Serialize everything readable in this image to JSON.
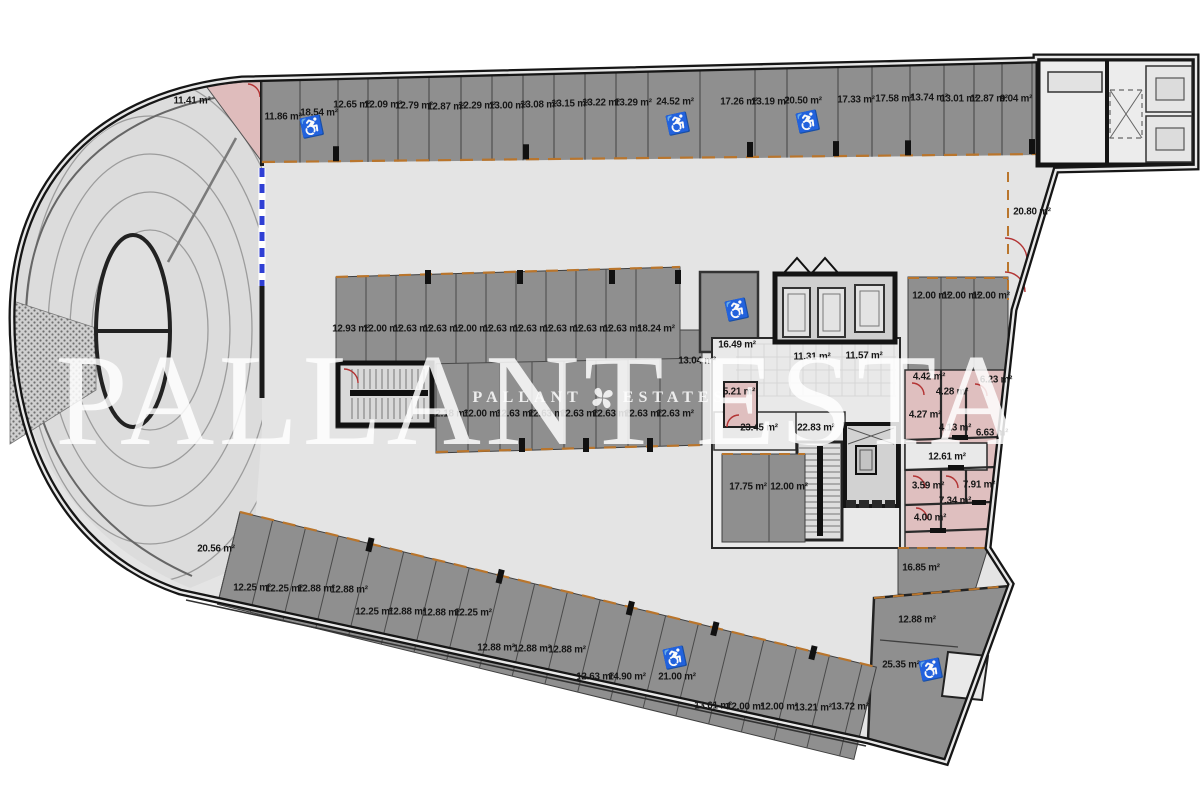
{
  "watermark": {
    "brand_left": "PALLANT",
    "brand_right": "ESTATES",
    "logo": "four-petal-flower"
  },
  "palette": {
    "stall_gray": "#8f8f8f",
    "aisle_gray": "#e4e4e4",
    "ramp_gray": "#dcdcdc",
    "room_pink": "#dfbfbf",
    "marking_orange": "#b9752c",
    "gate_blue": "#2f3fd4",
    "door_red": "#b33434",
    "wall_dark": "#1a1a1a",
    "watermark_white": "rgba(255,255,255,0.84)"
  },
  "plan": {
    "area_labels": [
      [
        "11.41 m²",
        192,
        101
      ],
      [
        "11.86 m²",
        283,
        117
      ],
      [
        "18.54 m²",
        319,
        113
      ],
      [
        "12.65 m²",
        352,
        105
      ],
      [
        "12.09 m²",
        383,
        105
      ],
      [
        "12.79 m²",
        414,
        106
      ],
      [
        "12.87 m²",
        446,
        107
      ],
      [
        "12.29 m²",
        477,
        106
      ],
      [
        "13.00 m²",
        508,
        106
      ],
      [
        "13.08 m²",
        539,
        105
      ],
      [
        "13.15 m²",
        570,
        104
      ],
      [
        "13.22 m²",
        601,
        103
      ],
      [
        "13.29 m²",
        633,
        103
      ],
      [
        "24.52 m²",
        675,
        102
      ],
      [
        "17.26 m²",
        739,
        102
      ],
      [
        "13.19 m²",
        770,
        102
      ],
      [
        "20.50 m²",
        803,
        101
      ],
      [
        "17.33 m²",
        856,
        100
      ],
      [
        "17.58 m²",
        894,
        99
      ],
      [
        "13.74 m²",
        929,
        98
      ],
      [
        "13.01 m²",
        959,
        99
      ],
      [
        "12.87 m²",
        989,
        99
      ],
      [
        "9.04 m²",
        1016,
        99
      ],
      [
        "12.93 m²",
        351,
        329
      ],
      [
        "12.00 m²",
        382,
        329
      ],
      [
        "12.63 m²",
        412,
        329
      ],
      [
        "12.63 m²",
        442,
        329
      ],
      [
        "12.00 m²",
        472,
        329
      ],
      [
        "12.63 m²",
        502,
        329
      ],
      [
        "12.63 m²",
        532,
        329
      ],
      [
        "12.63 m²",
        562,
        329
      ],
      [
        "12.63 m²",
        592,
        329
      ],
      [
        "12.63 m²",
        622,
        329
      ],
      [
        "18.24 m²",
        656,
        329
      ],
      [
        "13.04 m²",
        697,
        361
      ],
      [
        "12.18 m²",
        449,
        414
      ],
      [
        "12.00 m²",
        482,
        414
      ],
      [
        "12.63 m²",
        515,
        414
      ],
      [
        "12.63 m²",
        547,
        414
      ],
      [
        "12.63 m²",
        579,
        414
      ],
      [
        "12.63 m²",
        611,
        414
      ],
      [
        "12.63 m²",
        643,
        414
      ],
      [
        "12.63 m²",
        675,
        414
      ],
      [
        "16.49 m²",
        737,
        345
      ],
      [
        "11.31 m²",
        812,
        357
      ],
      [
        "11.57 m²",
        864,
        356
      ],
      [
        "5.21 m²",
        739,
        392
      ],
      [
        "23.45 m²",
        759,
        428
      ],
      [
        "22.83 m²",
        816,
        428
      ],
      [
        "17.75 m²",
        748,
        487
      ],
      [
        "12.00 m²",
        789,
        487
      ],
      [
        "20.80 m²",
        1032,
        212
      ],
      [
        "12.00 m²",
        931,
        296
      ],
      [
        "12.00 m²",
        961,
        296
      ],
      [
        "12.00 m²",
        991,
        296
      ],
      [
        "4.42 m²",
        929,
        377
      ],
      [
        "6.23 m²",
        996,
        380
      ],
      [
        "4.28 m²",
        952,
        392
      ],
      [
        "4.27 m²",
        925,
        415
      ],
      [
        "4.13 m²",
        955,
        428
      ],
      [
        "6.63 m²",
        992,
        433
      ],
      [
        "12.61 m²",
        947,
        457
      ],
      [
        "3.59 m²",
        928,
        486
      ],
      [
        "7.91 m²",
        979,
        485
      ],
      [
        "7.34 m²",
        955,
        501
      ],
      [
        "4.00 m²",
        930,
        518
      ],
      [
        "16.85 m²",
        921,
        568
      ],
      [
        "12.88 m²",
        917,
        620
      ],
      [
        "25.35 m²",
        901,
        665
      ],
      [
        "20.56 m²",
        216,
        549
      ],
      [
        "12.25 m²",
        252,
        588
      ],
      [
        "12.25 m²",
        284,
        589
      ],
      [
        "12.88 m²",
        316,
        589
      ],
      [
        "12.88 m²",
        349,
        590
      ],
      [
        "12.25 m²",
        374,
        612
      ],
      [
        "12.88 m²",
        407,
        612
      ],
      [
        "12.88 m²",
        441,
        613
      ],
      [
        "12.25 m²",
        473,
        613
      ],
      [
        "12.88 m²",
        496,
        648
      ],
      [
        "12.88 m²",
        532,
        649
      ],
      [
        "12.88 m²",
        567,
        650
      ],
      [
        "12.63 m²",
        595,
        677
      ],
      [
        "14.90 m²",
        627,
        677
      ],
      [
        "21.00 m²",
        677,
        677
      ],
      [
        "13.61 m²",
        713,
        706
      ],
      [
        "12.00 m²",
        745,
        707
      ],
      [
        "12.00 m²",
        779,
        707
      ],
      [
        "13.21 m²",
        813,
        708
      ],
      [
        "13.72 m²",
        850,
        707
      ]
    ],
    "icons": [
      [
        "wheelchair-icon",
        312,
        128
      ],
      [
        "wheelchair-icon",
        678,
        125
      ],
      [
        "wheelchair-icon",
        808,
        123
      ],
      [
        "stroller-icon",
        737,
        311
      ],
      [
        "trolley-icon",
        675,
        659
      ],
      [
        "wheelchair-icon",
        931,
        671
      ]
    ]
  }
}
